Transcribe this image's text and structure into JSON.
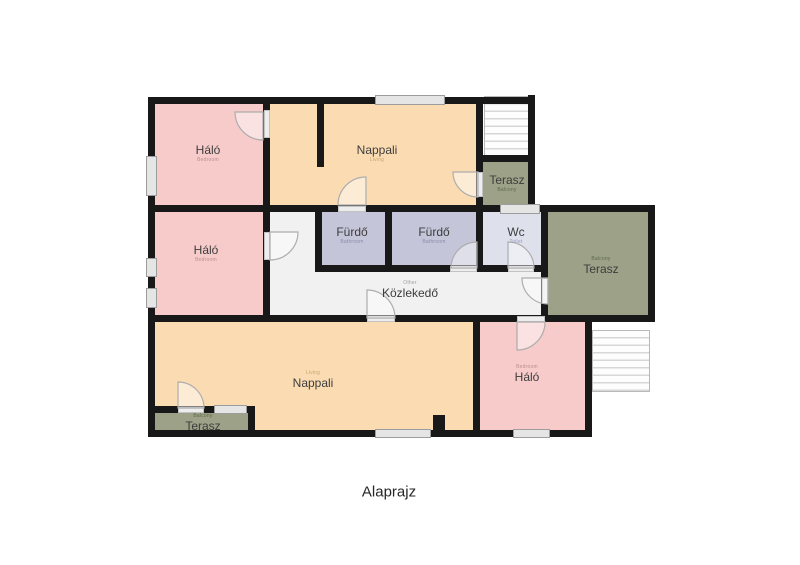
{
  "title": "Alaprajz",
  "colors": {
    "bedroom": "#f6cbca",
    "living": "#fbdcb2",
    "bathroom": "#c5c5d9",
    "toilet": "#dee0ec",
    "balcony": "#9ca187",
    "hallway": "#f1f1f2",
    "wall": "#181818"
  },
  "rooms": [
    {
      "name": "Háló",
      "type": "Bedroom"
    },
    {
      "name": "Nappali",
      "type": "Living"
    },
    {
      "name": "Terasz",
      "type": "Balcony"
    },
    {
      "name": "Fürdő",
      "type": "Bathroom"
    },
    {
      "name": "Fürdő",
      "type": "Bathroom"
    },
    {
      "name": "Wc",
      "type": "Toilet"
    },
    {
      "name": "Háló",
      "type": "Bedroom"
    },
    {
      "name": "Terasz",
      "type": "Balcony"
    },
    {
      "name": "Közlekedő",
      "type": "Other"
    },
    {
      "name": "Nappali",
      "type": "Living"
    },
    {
      "name": "Háló",
      "type": "Bedroom"
    },
    {
      "name": "Terasz",
      "type": "Balcony"
    }
  ]
}
